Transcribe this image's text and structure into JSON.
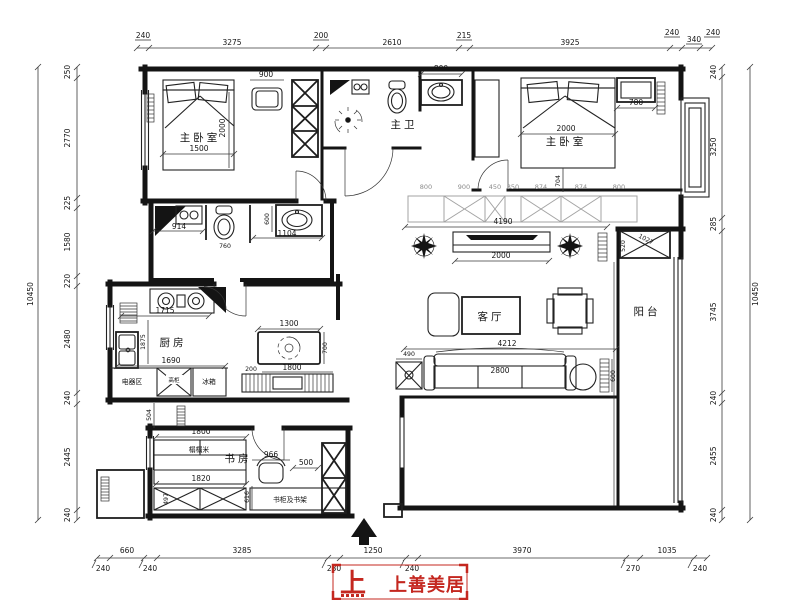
{
  "drawing": {
    "rooms": {
      "master_bedroom": "主卧室",
      "master_bath": "主卫",
      "kitchen": "厨房",
      "living_room": "客厅",
      "balcony": "阳台",
      "study": "书房"
    },
    "furniture_labels": {
      "appliance_area": "电器区",
      "tall_cabinet": "高柜",
      "fridge": "冰箱",
      "tatami": "榻榻米",
      "bookcase_shelf": "书柜及书架"
    },
    "dims": {
      "top": [
        "240",
        "3275",
        "200",
        "2610",
        "215",
        "3925",
        "240",
        "340",
        "240"
      ],
      "bottom": [
        "240",
        "660",
        "240",
        "3285",
        "230",
        "1250",
        "240",
        "3970",
        "270",
        "1035",
        "240"
      ],
      "left": [
        "250",
        "2770",
        "225",
        "1580",
        "220",
        "2480",
        "240",
        "2445",
        "240"
      ],
      "left_total": "10450",
      "right": [
        "240",
        "3250",
        "285",
        "3745",
        "240",
        "2455",
        "240"
      ],
      "right_total": "10450",
      "interior": {
        "bed1_bench": "900",
        "bed1_len": "2000",
        "bed1_w": "1500",
        "bath_sink": "800",
        "bed2_len": "2000",
        "bed2_cab": "780",
        "bed2_depth": "704",
        "ward": [
          "800",
          "900",
          "450",
          "350",
          "874",
          "874",
          "800"
        ],
        "ward_total": "4190",
        "tv_wall": "2000",
        "balc_diag": "1027",
        "balc_side": "520",
        "bath2_w": "914",
        "bath2_toilet": "760",
        "bath2_sink": "1104",
        "bath2_d": "600",
        "kit_a": "1715",
        "kit_b": "1875",
        "kit_c": "1690",
        "table_w": "1300",
        "table_d": "700",
        "bench_gap": "200",
        "bench_w": "1800",
        "hall": "504",
        "tatami_a": "1800",
        "tatami_b": "1820",
        "chair": "966",
        "desk": "500",
        "shelf": "616",
        "cab": "497",
        "living_total": "4212",
        "sofa": "2800",
        "side_table": "490",
        "living_side": "600"
      }
    }
  },
  "logo": {
    "mark": "上",
    "brand": "上善美居"
  },
  "colors": {
    "line": "#141414",
    "accent_red": "#c4271f",
    "cabinet_gray": "#a3a3a3"
  }
}
